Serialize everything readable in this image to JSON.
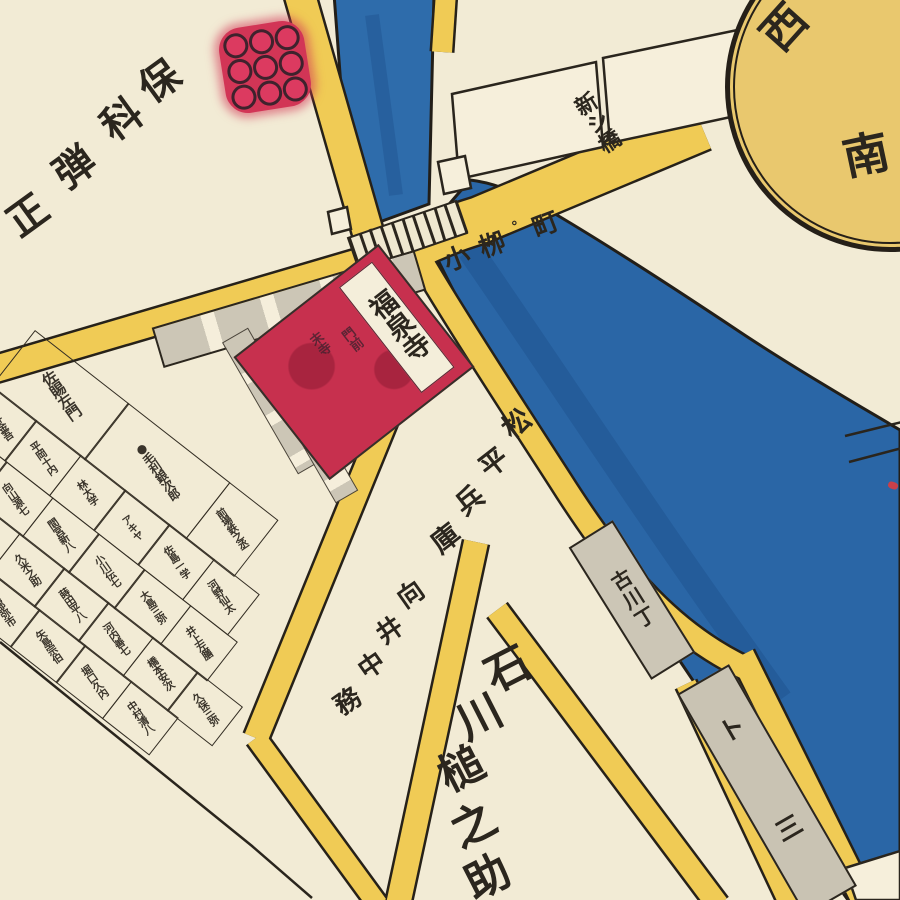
{
  "compass": {
    "west": "西",
    "south": "南"
  },
  "crest": {
    "name": "kuyo-nine-circle-crest",
    "dots": 9
  },
  "labels": {
    "hoshina_danjo": "保科弾正",
    "koyanagi_road": "小栁°町",
    "bridge_area": "新シ橋",
    "temple_main": "福泉寺",
    "temple_sub_left": "末寺",
    "temple_sub_right": "門前",
    "matsudaira_hyogo": "松平兵庫",
    "mukai_nakatsukasa": "向井中務",
    "ishikawa_tsuchinosuke": "石川槌之助",
    "furukawa_cho": "古川丁",
    "corner_strip": "ト三",
    "sajima_block": "佐賜左門",
    "mori_block": "毛利銀次郎",
    "mori_dot": "●"
  },
  "plot_names_approx": [
    "前場鉄之丞",
    "沢井金吾",
    "平岡十内",
    "林大学",
    "アキヤ",
    "佐島一学",
    "河野仙太",
    "久保久米",
    "向山源七",
    "間宮新八",
    "小川伝七",
    "大島三弥",
    "井上左膳",
    "森川岩松",
    "沖津八郎",
    "久米之助",
    "蒔田平八",
    "河内善七",
    "橋本安次",
    "久保三弥",
    "亀井要人",
    "津田半六",
    "岡部弥市",
    "矢島宗伯",
    "堀口久内",
    "中村清八"
  ],
  "colors": {
    "paper": "#f2ebd5",
    "road_yellow": "#f0cb55",
    "water_blue": "#2a66a6",
    "temple_red": "#c7304e",
    "strip_gray": "#cbc5b5",
    "ink": "#2b261e",
    "crest_red": "#d23556",
    "compass_fill": "#e9c86e"
  }
}
